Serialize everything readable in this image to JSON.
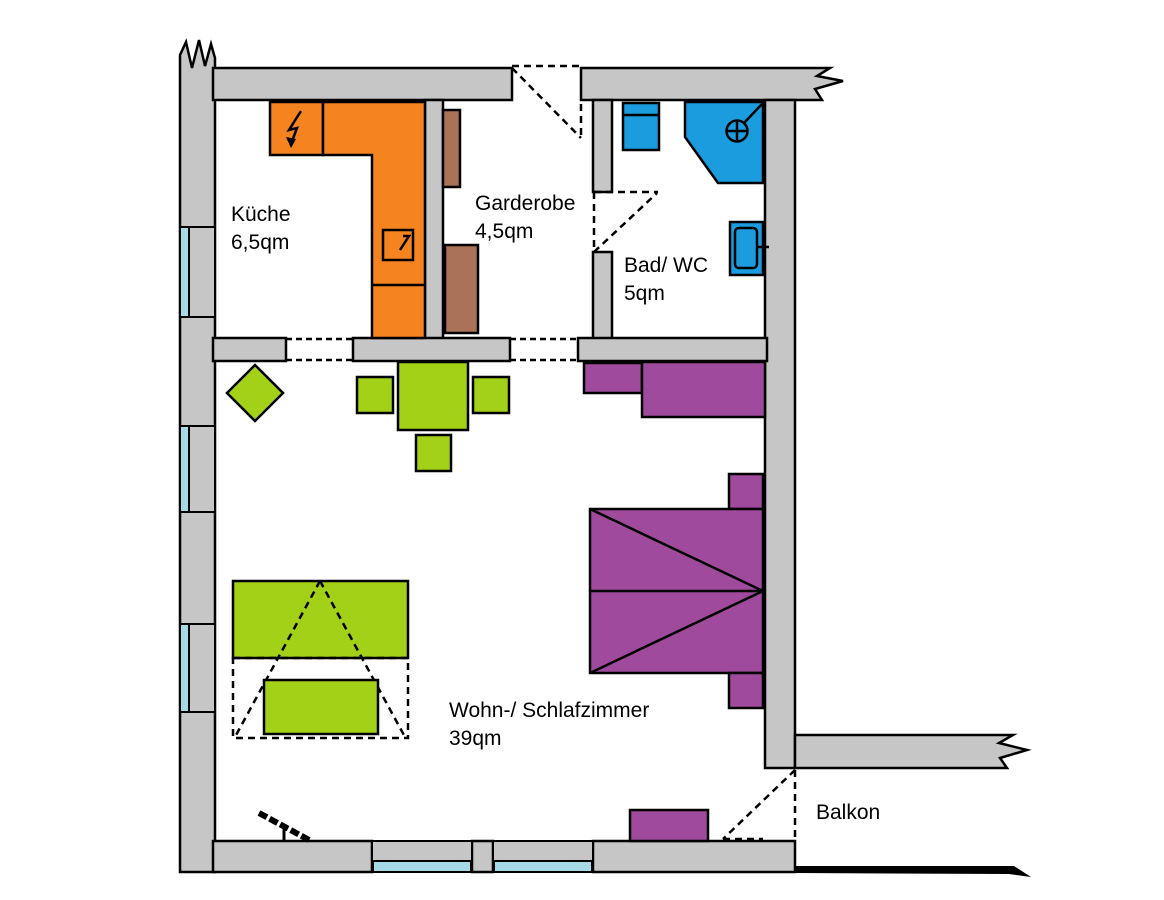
{
  "floorplan": {
    "rooms": [
      {
        "id": "kueche",
        "name": "Küche",
        "area": "6,5qm"
      },
      {
        "id": "garderobe",
        "name": "Garderobe",
        "area": "4,5qm"
      },
      {
        "id": "bad",
        "name": "Bad/ WC",
        "area": "5qm"
      },
      {
        "id": "wohnzimmer",
        "name": "Wohn-/ Schlafzimmer",
        "area": "39qm"
      },
      {
        "id": "balkon",
        "name": "Balkon",
        "area": ""
      }
    ],
    "colors": {
      "background": "#ffffff",
      "wall": "#c6c6c6",
      "outline": "#000000",
      "kitchen_orange": "#f5831f",
      "garderobe_brown": "#aa7357",
      "bath_blue": "#1a9cdf",
      "furniture_green": "#a3d118",
      "furniture_purple": "#a04a9e",
      "window_blue": "#a5d9e6"
    }
  }
}
